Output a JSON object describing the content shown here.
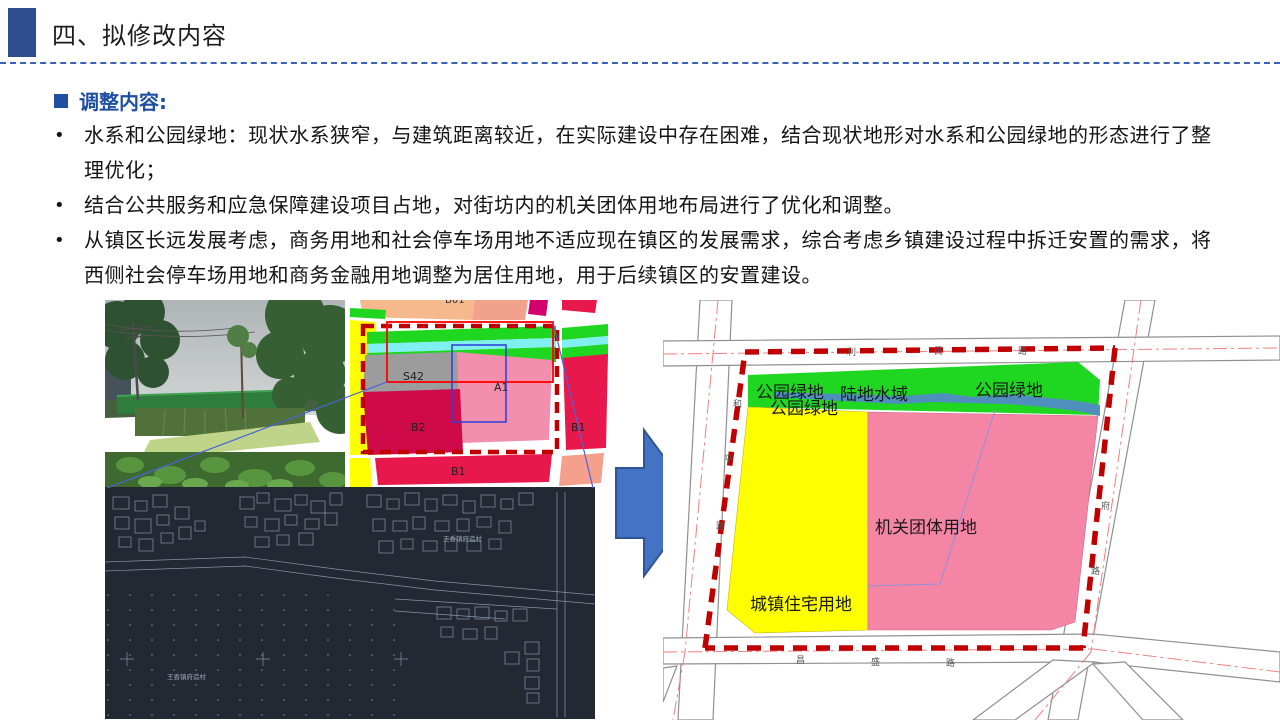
{
  "slide": {
    "title": "四、拟修改内容",
    "section_heading": "调整内容:",
    "bullets": [
      "水系和公园绿地：现状水系狭窄，与建筑距离较近，在实际建设中存在困难，结合现状地形对水系和公园绿地的形态进行了整理优化；",
      "结合公共服务和应急保障建设项目占地，对街坊内的机关团体用地布局进行了优化和调整。",
      "从镇区长远发展考虑，商务用地和社会停车场用地不适应现在镇区的发展需求，综合考虑乡镇建设过程中拆迁安置的需求，将西侧社会停车场用地和商务金融用地调整为居住用地，用于后续镇区的安置建设。"
    ]
  },
  "mid_map": {
    "top_partial_label": "B01",
    "s42": "S42",
    "a1": "A1",
    "b2": "B2",
    "b1_bottom": "B1",
    "b1_right": "B1"
  },
  "right_map": {
    "park_green_top": "公园绿地",
    "park_green_left": "公园绿地",
    "park_green_right": "公园绿地",
    "water": "陆地水域",
    "residential": "城镇住宅用地",
    "government": "机关团体用地",
    "roads": {
      "top": [
        "利",
        "民",
        "路"
      ],
      "left": [
        "和",
        "平",
        "路"
      ],
      "bottom": [
        "昌",
        "盛",
        "路"
      ],
      "right": [
        "府",
        "路"
      ]
    }
  },
  "cad_map": {
    "village_label": "王香镇府造村",
    "village_label_right": "王香镇府造村"
  },
  "colors": {
    "accent_blue": "#2E4D8F",
    "heading_blue": "#1F4FA0",
    "boundary_red": "#C00000",
    "arrow_blue": "#4472C4",
    "park_green": "#1FD621",
    "water_blue": "#4E8FBE",
    "residential_yellow": "#FFFF00",
    "government_pink": "#F585A5"
  }
}
